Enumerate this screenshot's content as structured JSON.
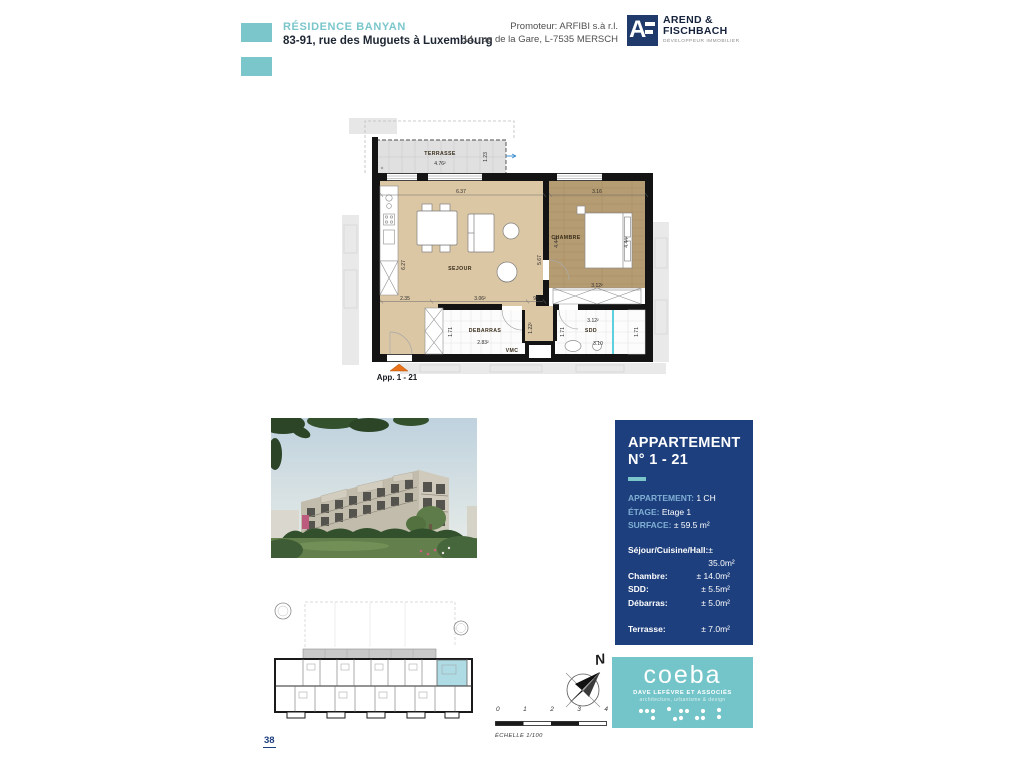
{
  "colors": {
    "accent_teal": "#7AC6CB",
    "panel_navy": "#1E3F7D",
    "floor_beige": "#DCC7A5",
    "floor_wood": "#B69C72",
    "highlight_unit": "#AEDBE4",
    "arrow_orange": "#E8731A"
  },
  "header": {
    "project_name": "RÉSIDENCE BANYAN",
    "project_address": "83-91, rue des Muguets à Luxembourg",
    "promoter_line1": "Promoteur: ARFIBI s.à r.l.",
    "promoter_line2": "14, rue de la Gare, L-7535 MERSCH",
    "logo": {
      "initial": "A",
      "name_line1": "AREND &",
      "name_line2": "FISCHBACH",
      "tagline": "DÉVELOPPEUR IMMOBILIER"
    }
  },
  "plan": {
    "app_label": "App. 1 - 21",
    "rooms": {
      "terrasse": "TERRASSE",
      "sejour": "SEJOUR",
      "chambre": "CHAMBRE",
      "debarras": "DEBARRAS",
      "sdd": "SDD",
      "vmc": "VMC"
    },
    "areas": {
      "terrasse": "4.76²",
      "sejour_part": "3.06²",
      "chambre_part": "3.12²",
      "debarras": "2.83²",
      "sdd_part": "3.12²"
    },
    "dims": {
      "terrasse_depth": "1.23",
      "sejour_top": "6.37",
      "chambre_top": "3.16",
      "sejour_left": "6.27",
      "sejour_right": "5.67",
      "bed_left": "4.44²",
      "bed_right": "4.44²",
      "bottom_1": "2.35",
      "bottom_3": "95",
      "hall": "1.22²",
      "debarras_depth": "1.71",
      "sdd_left": "1.71",
      "sdd_right": "1.71",
      "sdd_width": "3.10"
    }
  },
  "info_panel": {
    "title_line1": "APPARTEMENT",
    "title_line2": "N° 1 - 21",
    "details": [
      {
        "label": "APPARTEMENT:",
        "value": "1 CH"
      },
      {
        "label": "ÉTAGE:",
        "value": "Etage 1"
      },
      {
        "label": "SURFACE:",
        "value": "± 59.5 m²"
      }
    ],
    "areas": [
      {
        "label": "Séjour/Cuisine/Hall:",
        "value": "± 35.0m²"
      },
      {
        "label": "Chambre:",
        "value": "± 14.0m²"
      },
      {
        "label": "SDD:",
        "value": "± 5.5m²"
      },
      {
        "label": "Débarras:",
        "value": "± 5.0m²"
      },
      {
        "label": "Terrasse:",
        "value": "± 7.0m²"
      }
    ]
  },
  "compass": {
    "north": "N"
  },
  "scale": {
    "ticks": [
      "0",
      "1",
      "2",
      "3",
      "4"
    ],
    "label": "ÉCHELLE  1/100"
  },
  "coeba": {
    "name": "coeba",
    "line1": "DAVE LEFÈVRE ET ASSOCIÉS",
    "line2": "architecture, urbanisme & design"
  },
  "page": {
    "number": "38"
  }
}
